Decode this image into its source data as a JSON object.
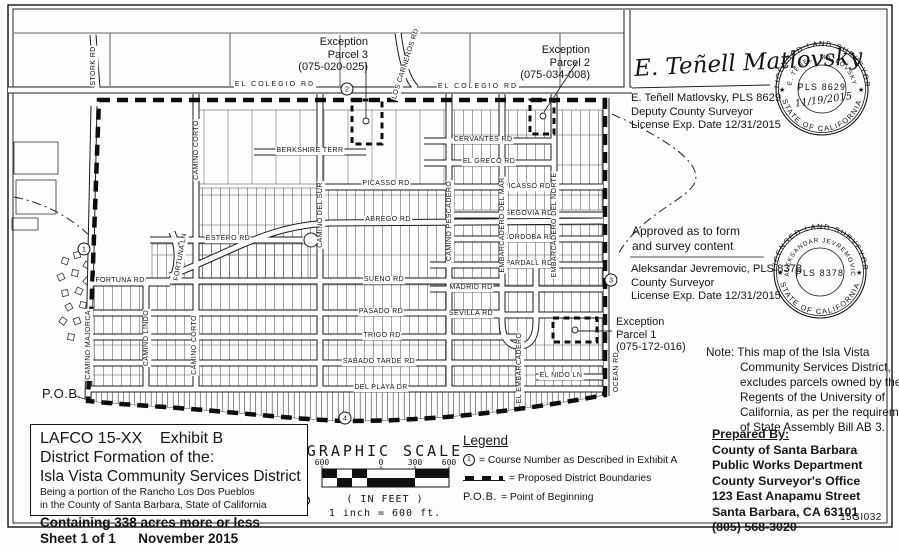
{
  "document": {
    "drawing_number": "15GI032"
  },
  "title_block": {
    "line1": "LAFCO 15-XX    Exhibit B",
    "line2": "District Formation of the:",
    "line3": "Isla Vista Community Services District",
    "line4": "Being a portion of the Rancho Los Dos Pueblos",
    "line5": "in the County of Santa Barbara, State of California",
    "line6": "Containing 338 acres more or less",
    "line7": "Sheet 1 of 1      November 2015"
  },
  "scale": {
    "title": "GRAPHIC SCALE",
    "ticks": [
      "600",
      "0",
      "300",
      "600"
    ],
    "units_label": "( IN FEET )",
    "ratio_label": "1 inch = 600 ft."
  },
  "legend": {
    "title": "Legend",
    "course_symbol": "1",
    "course_text": "= Course Number as Described in Exhibit A",
    "boundary_text": "= Proposed District Boundaries",
    "pob_symbol": "P.O.B.",
    "pob_text": "= Point of Beginning"
  },
  "prepared_by": {
    "heading": "Prepared By:",
    "lines": [
      "County of Santa Barbara",
      "Public Works Department",
      "County Surveyor's Office",
      "123 East Anapamu Street",
      "Santa Barbara, CA 63101",
      "(805) 568-3020"
    ]
  },
  "note": {
    "lines": [
      "Note: This map of the Isla Vista",
      "Community Services District,",
      "excludes parcels owned by the",
      "Regents of the University of",
      "California, as per the requirements",
      "of State Assembly Bill AB 3."
    ]
  },
  "signoff": {
    "signature": "E. Teñell Matlovsky",
    "name": "E. Teñell Matlovsky, PLS 8629",
    "title": "Deputy County Surveyor",
    "license": "License Exp. Date 12/31/2015"
  },
  "approval": {
    "line1": "Approved as to form",
    "line2": "and survey content",
    "name": "Aleksandar Jevremovic, PLS 8378",
    "title": "County Surveyor",
    "license": "License Exp. Date 12/31/2015"
  },
  "stamps": {
    "s1": {
      "top": "LICENSED LAND SURVEYOR",
      "name": "E. TEÑELL MATLOVSKY",
      "center": "PLS 8629",
      "date": "11/19/2015",
      "bottom": "STATE OF CALIFORNIA"
    },
    "s2": {
      "top": "LICENSED LAND SURVEYOR",
      "name": "ALEKSANDAR JEVREMOVIC",
      "center": "PLS 8378",
      "bottom": "STATE OF CALIFORNIA"
    }
  },
  "exceptions": {
    "p3": {
      "l1": "Exception",
      "l2": "Parcel 3",
      "l3": "(075-020-025)"
    },
    "p2": {
      "l1": "Exception",
      "l2": "Parcel 2",
      "l3": "(075-034-008)"
    },
    "p1": {
      "l1": "Exception",
      "l2": "Parcel 1",
      "l3": "(075-172-016)"
    }
  },
  "pob": "P.O.B.",
  "courses": {
    "c1": "1",
    "c2": "2",
    "c3": "3",
    "c4": "4"
  },
  "streets": {
    "el_colegio_a": "EL COLEGIO RD",
    "el_colegio_b": "EL COLEGIO RD",
    "stork_rd": "STORK RD",
    "los_carneros": "LOS CARNEROS RD",
    "camino_corto_n": "CAMINO CORTO",
    "berkshire": "BERKSHIRE TERR",
    "cervantes": "CERVANTES RD",
    "el_greco": "EL GRECO RD",
    "picasso_a": "PICASSO RD",
    "picasso_b": "PICASSO RD",
    "abrego": "ABREGO RD",
    "estero": "ESTERO RD",
    "segovia": "SEGOVIA RD",
    "cordoba": "CORDOBA RD",
    "pardall": "PARDALL RD",
    "sueno": "SUENO RD",
    "madrid": "MADRID RD",
    "sevilla": "SEVILLA RD",
    "pasado": "PASADO RD",
    "trigo": "TRIGO RD",
    "sabado": "SABADO TARDE RD",
    "del_playa": "DEL PLAYA DR",
    "el_nido": "EL NIDO LN",
    "fortuna_rd": "FORTUNA RD",
    "fortuna_ln": "FORTUNA LN",
    "camino_majorca": "CAMINO MAJORCA",
    "camino_lindo": "CAMINO LINDO",
    "camino_corto_s": "CAMINO CORTO",
    "camino_del_sur": "CAMINO DEL SUR",
    "camino_pescadero": "CAMINO PESCADERO",
    "emb_del_mar": "EMBARCADERO DEL MAR",
    "emb_del_norte": "EMBARCADERO DEL NORTE",
    "el_embarcadero": "EL EMBARCADERO",
    "ocean_rd": "OCEAN RD"
  }
}
